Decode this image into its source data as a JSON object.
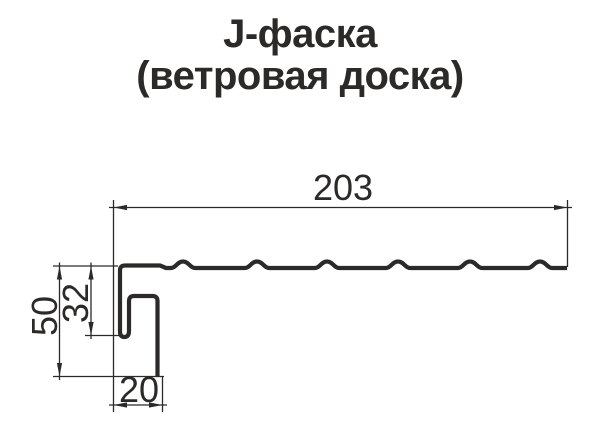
{
  "title": {
    "line1": "J-фаска",
    "line2": "(ветровая доска)"
  },
  "drawing": {
    "dimensions": {
      "top_width": "203",
      "total_height": "50",
      "inner_height": "32",
      "bottom_width": "20"
    }
  },
  "colors": {
    "line": "#2b2a29",
    "background": "#ffffff"
  }
}
